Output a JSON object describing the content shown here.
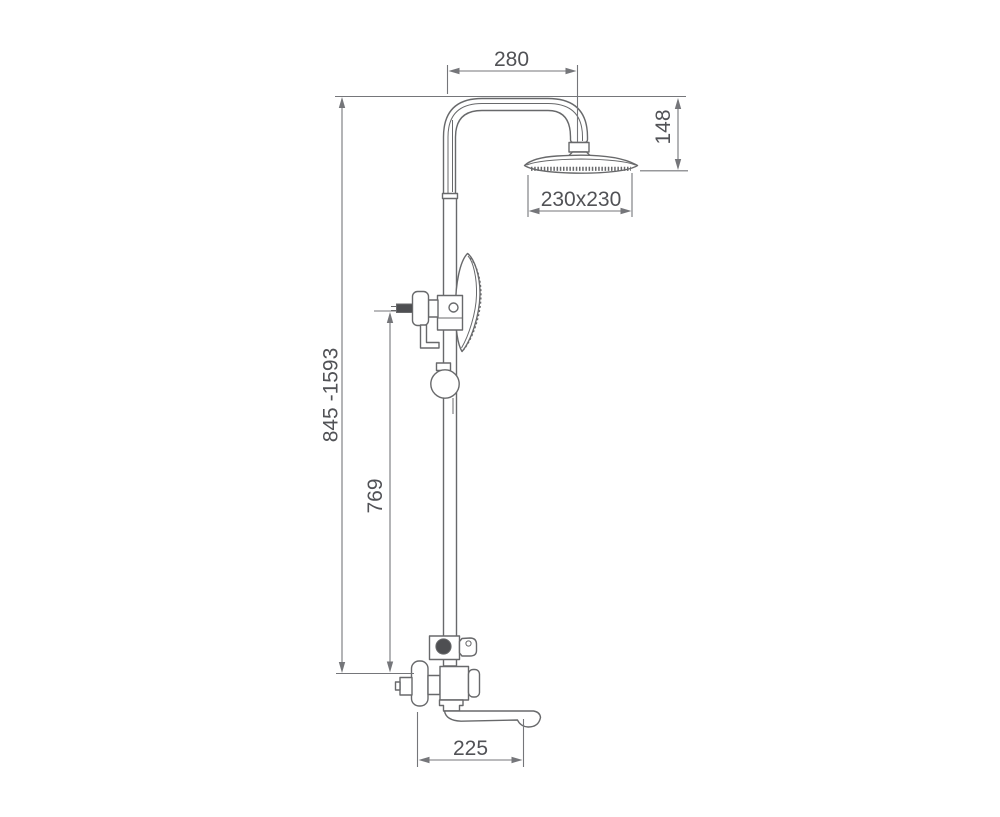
{
  "drawing": {
    "name": "Shower column technical dimension drawing",
    "colors": {
      "line": "#68696b",
      "dim": "#75767a",
      "text": "#515256",
      "dark": "#4e4f52",
      "background": "#ffffff"
    },
    "dimensions": {
      "arm_reach": "280",
      "head_drop": "148",
      "head_size": "230x230",
      "total_height": "845 -1593",
      "hand_shower_height": "769",
      "spout_reach": "225"
    }
  }
}
